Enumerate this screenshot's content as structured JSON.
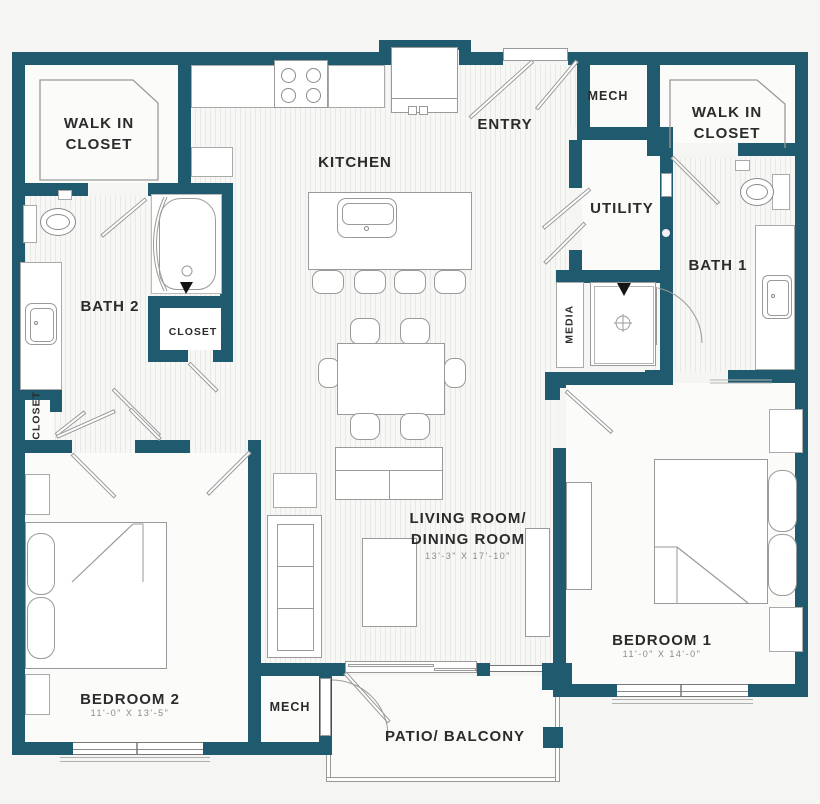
{
  "title": "Two bedroom apartment floor plan",
  "colors": {
    "wall": "#1f5a6e",
    "background": "#f5f5f4",
    "floor_stripe": "#e9eae6",
    "label_text": "#2b2b2b",
    "dimension_text": "#8a8a8a",
    "fixture_line": "#9a9a9a"
  },
  "rooms": {
    "walk_in_closet_left": {
      "line1": "WALK IN",
      "line2": "CLOSET"
    },
    "walk_in_closet_right": {
      "line1": "WALK IN",
      "line2": "CLOSET"
    },
    "kitchen": {
      "label": "KITCHEN"
    },
    "entry": {
      "label": "ENTRY"
    },
    "mech_top": {
      "label": "MECH"
    },
    "mech_bottom": {
      "label": "MECH"
    },
    "utility": {
      "label": "UTILITY"
    },
    "bath1": {
      "label": "BATH 1"
    },
    "bath2": {
      "label": "BATH 2"
    },
    "closet_hall": {
      "label": "CLOSET"
    },
    "closet_left": {
      "label": "CLOSET"
    },
    "media": {
      "label": "MEDIA"
    },
    "living_dining": {
      "line1": "LIVING ROOM/",
      "line2": "DINING ROOM",
      "dimensions": "13'-3\" X 17'-10\""
    },
    "bedroom1": {
      "label": "BEDROOM 1",
      "dimensions": "11'-0\" X 14'-0\""
    },
    "bedroom2": {
      "label": "BEDROOM 2",
      "dimensions": "11'-0\" X 13'-5\""
    },
    "patio": {
      "label": "PATIO/ BALCONY"
    }
  }
}
